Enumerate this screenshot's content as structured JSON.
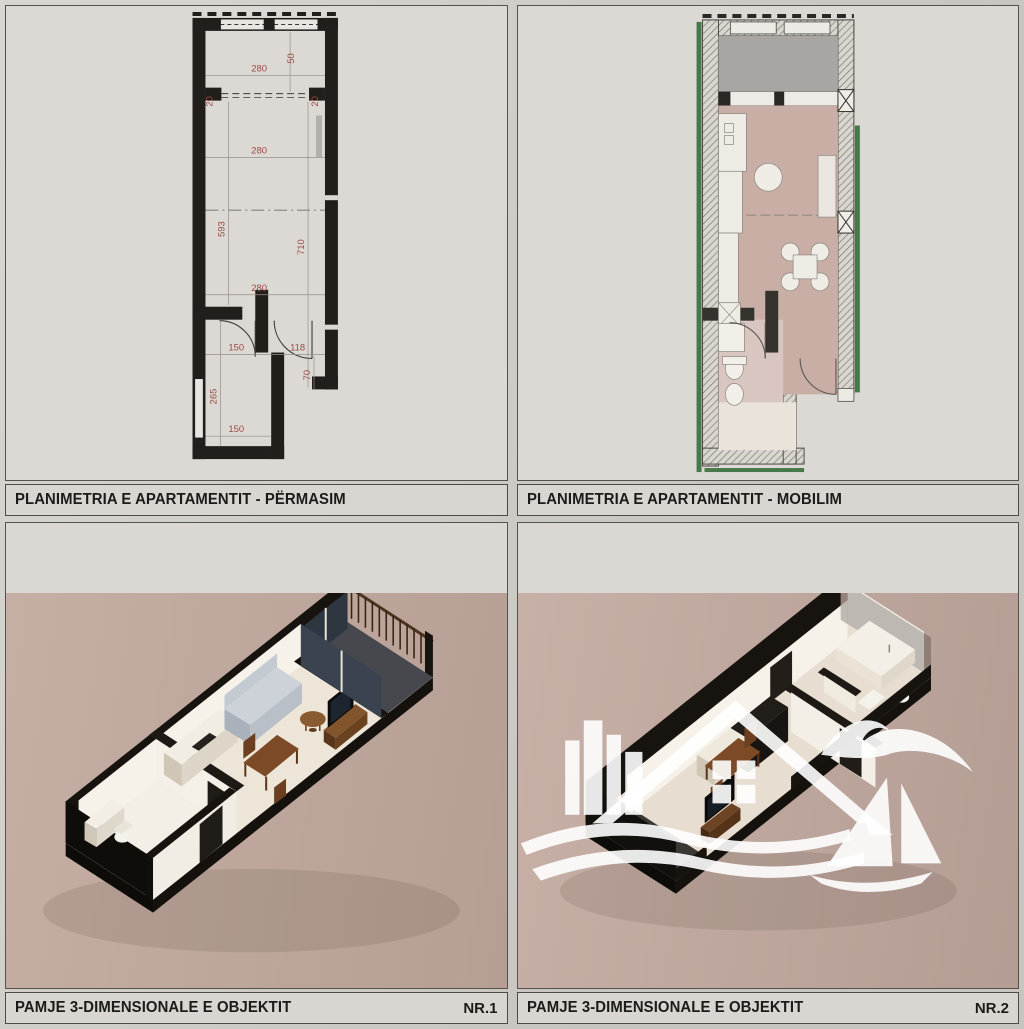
{
  "sheet": {
    "type": "real-estate floor plan sheet"
  },
  "panels": [
    {
      "id": "plan-dimensioned",
      "title": "PLANIMETRIA E APARTAMENTIT - PËRMASIM"
    },
    {
      "id": "plan-furnished",
      "title": "PLANIMETRIA E APARTAMENTIT - MOBILIM"
    },
    {
      "id": "view-3d-1",
      "title": "PAMJE 3-DIMENSIONALE E OBJEKTIT",
      "number": "NR.1"
    },
    {
      "id": "view-3d-2",
      "title": "PAMJE 3-DIMENSIONALE E OBJEKTIT",
      "number": "NR.2"
    }
  ],
  "plan_dimensions": {
    "balcony_width": "280",
    "balcony_depth": "50",
    "wall_left": "20",
    "wall_right": "20",
    "living_width": "280",
    "left_span": "593",
    "right_span": "710",
    "lower_width": "280",
    "bath_width": "150",
    "hall_width": "118",
    "bath_depth": "265",
    "door_width": "70",
    "bottom_width": "150"
  },
  "colors": {
    "sheet_bg": "#d3d0cb",
    "panel_bg": "#dcd9d4",
    "panel_border": "#55524e",
    "wall_black": "#211e1b",
    "dimension_red": "#9a4a43",
    "floor_rose": "#c8aea5",
    "terrace_gray": "#a9a5a3",
    "insulation_green": "#47784a",
    "render_bg_1": "#c1a89d",
    "render_bg_2": "#c3aaa0",
    "render_floor": "#ece5d8",
    "wood_brown": "#7c4a26",
    "sofa_gray": "#ccd2d8",
    "watermark_white": "#ffffff"
  },
  "watermark": {
    "elements": [
      "city-buildings-icon",
      "house-roof-icon",
      "window-icon",
      "seagull-icon",
      "sailboat-icon",
      "waves-icon"
    ]
  }
}
